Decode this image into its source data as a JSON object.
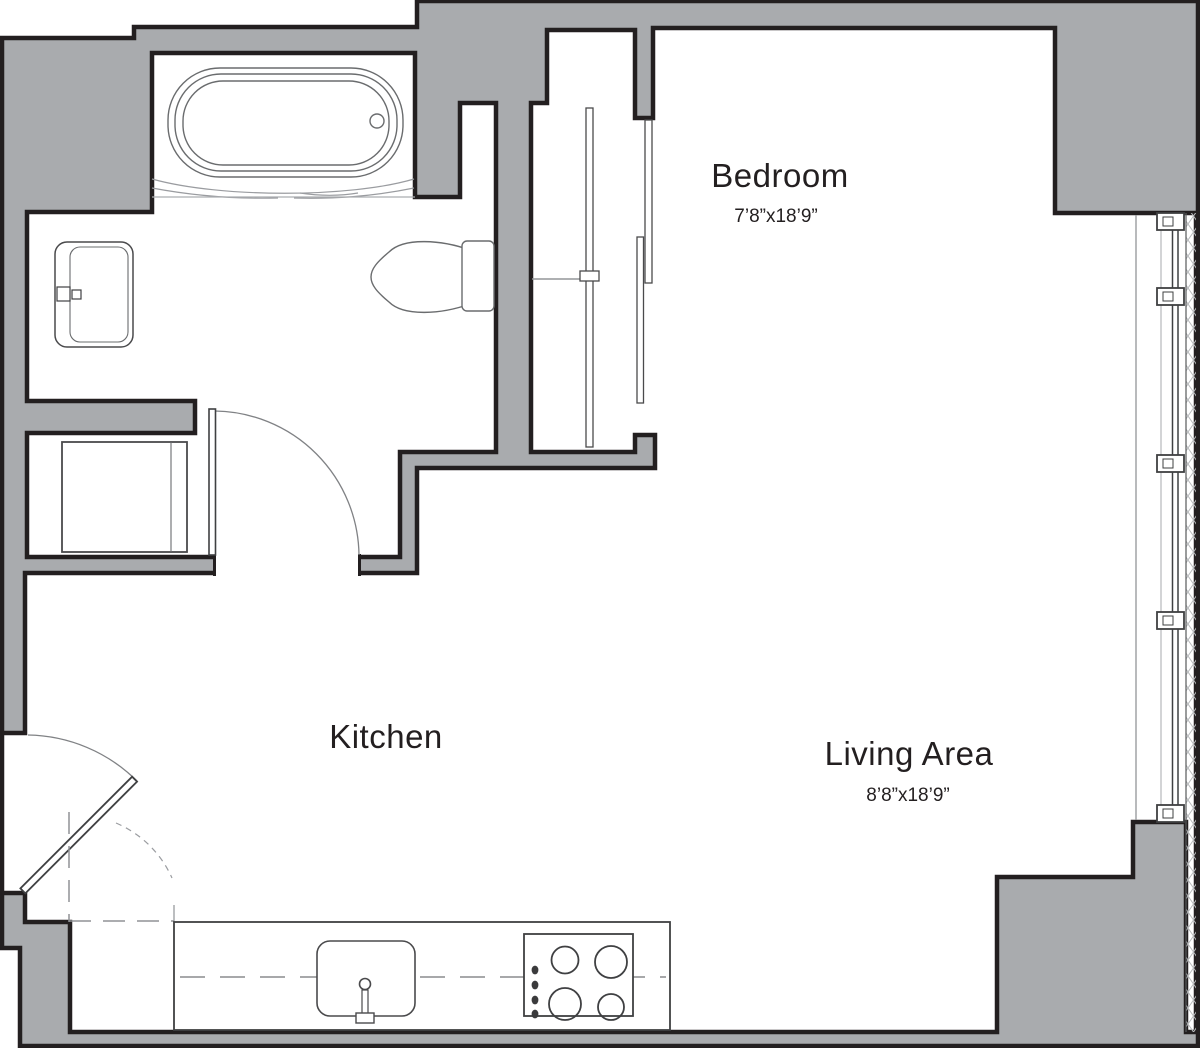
{
  "rooms": {
    "bedroom": {
      "label": "Bedroom",
      "dimensions": "7’8”x18’9”"
    },
    "kitchen": {
      "label": "Kitchen"
    },
    "living_area": {
      "label": "Living Area",
      "dimensions": "8’8”x18’9”"
    }
  },
  "colors": {
    "wall_fill": "#A9ABAE",
    "wall_outline": "#231F20",
    "fixture_line": "#4A4A4C",
    "light_line": "#939598",
    "hatch_line": "#B8BABC",
    "text": "#231F20",
    "background": "#FFFFFF"
  },
  "fixtures": {
    "bathroom": [
      "bathtub",
      "vanity-sink",
      "toilet",
      "washer",
      "swing-door"
    ],
    "closet": [
      "hanging-rod",
      "shelf",
      "sliding-door-panels"
    ],
    "kitchen": [
      "counter",
      "kitchen-sink",
      "faucet",
      "cooktop-4-burner",
      "upper-cabinets-dashed"
    ],
    "entry": [
      "entry-door",
      "door-swing-arc"
    ],
    "window_wall": [
      "floor-to-ceiling-window",
      "mullions",
      "hatched-strip"
    ]
  }
}
